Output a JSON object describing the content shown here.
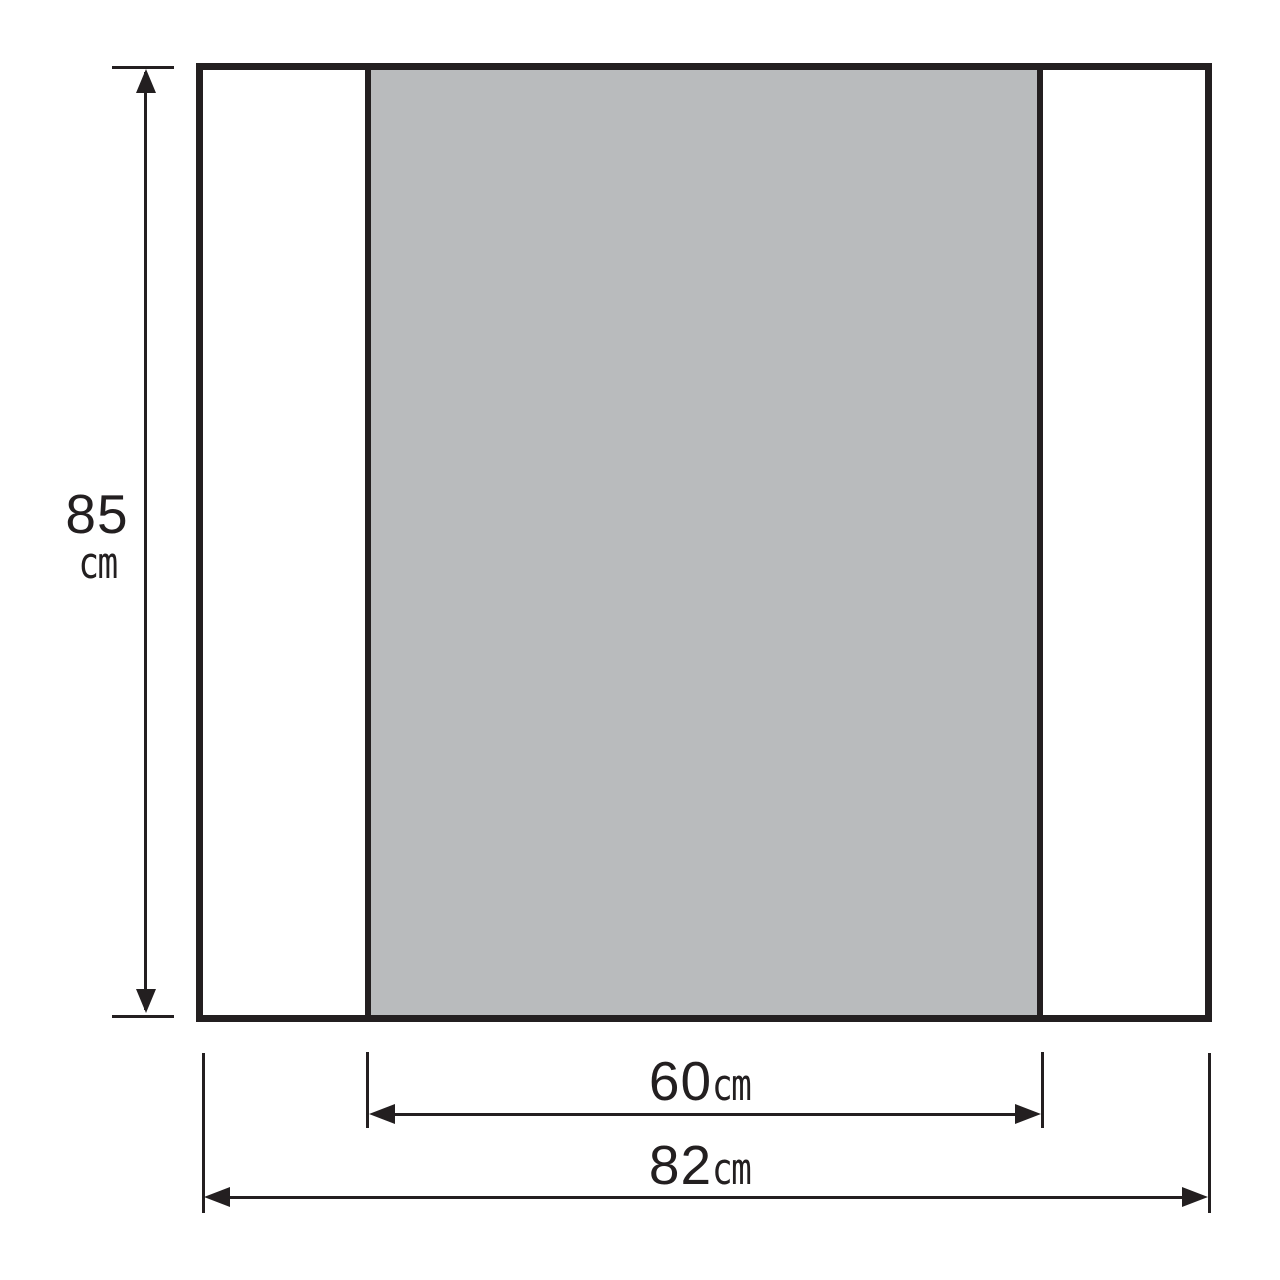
{
  "colors": {
    "line": "#231f20",
    "panel_fill": "#b9bbbd",
    "background": "#ffffff"
  },
  "diagram": {
    "type": "product-dimension-drawing",
    "labels": {
      "height": {
        "value": "85",
        "unit": "cm"
      },
      "panel_width": {
        "value": "60",
        "unit": "cm"
      },
      "total_width": {
        "value": "82",
        "unit": "cm"
      }
    }
  }
}
